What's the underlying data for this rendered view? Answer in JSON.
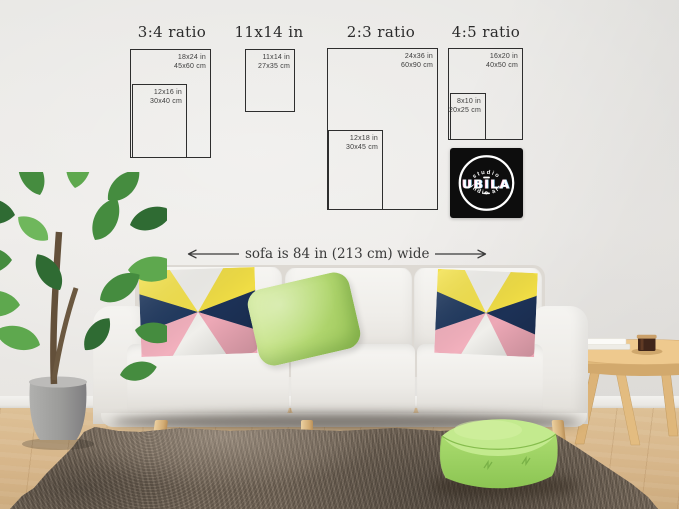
{
  "size_guide": {
    "groups": [
      {
        "title": "3:4 ratio",
        "outer_in": "18x24 in",
        "outer_cm": "45x60 cm",
        "inner_in": "12x16 in",
        "inner_cm": "30x40 cm"
      },
      {
        "title": "11x14 in",
        "outer_in": "11x14 in",
        "outer_cm": "27x35 cm"
      },
      {
        "title": "2:3 ratio",
        "outer_in": "24x36 in",
        "outer_cm": "60x90 cm",
        "inner_in": "12x18 in",
        "inner_cm": "30x45 cm"
      },
      {
        "title": "4:5 ratio",
        "outer_in": "16x20 in",
        "outer_cm": "40x50 cm",
        "inner_in": "8x10 in",
        "inner_cm": "20x25 cm"
      }
    ],
    "sofa_note": "sofa is 84 in (213 cm) wide"
  },
  "logo": {
    "top_text": "studio",
    "name": "UBILA",
    "bottom_text": "indie art"
  },
  "palette": {
    "wall": "#e9e8e5",
    "outline": "#2e2e2e",
    "label_text": "#3c3c3c",
    "floor_wood": "#d7b68a",
    "rug_brown": "#6e6155",
    "sofa_white": "#f3f2ee",
    "pillow_navy": "#20395f",
    "pillow_yellow": "#f4e24b",
    "pillow_pink": "#f2b0bd",
    "pillow_green": "#bfdf85",
    "pouf_green": "#a3d867",
    "table_wood": "#e5bd82",
    "plant_green": "#3f7d3c",
    "pot_gray": "#9b9b99",
    "logo_bg": "#0d0d0d",
    "logo_text": "#ffffff"
  }
}
